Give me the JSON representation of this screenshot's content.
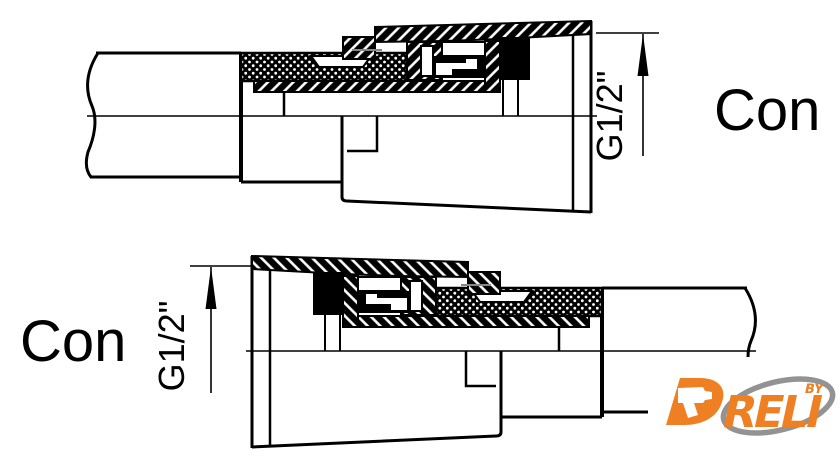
{
  "drawing": {
    "title": "hose to nut connection cross-sections",
    "top_view": {
      "cone_label": "Con",
      "thread_dimension": "G1/2\""
    },
    "bottom_view": {
      "cone_label": "Con",
      "thread_dimension": "G1/2\""
    },
    "colors": {
      "line": "#000000",
      "background": "#ffffff",
      "hatch_inner_line": "#888888"
    }
  },
  "logo": {
    "d_letter": "D",
    "wordmark_rest": "RELI",
    "by_label": "BY",
    "orange": "#EE7F22",
    "swoosh_gray": "#939393"
  }
}
